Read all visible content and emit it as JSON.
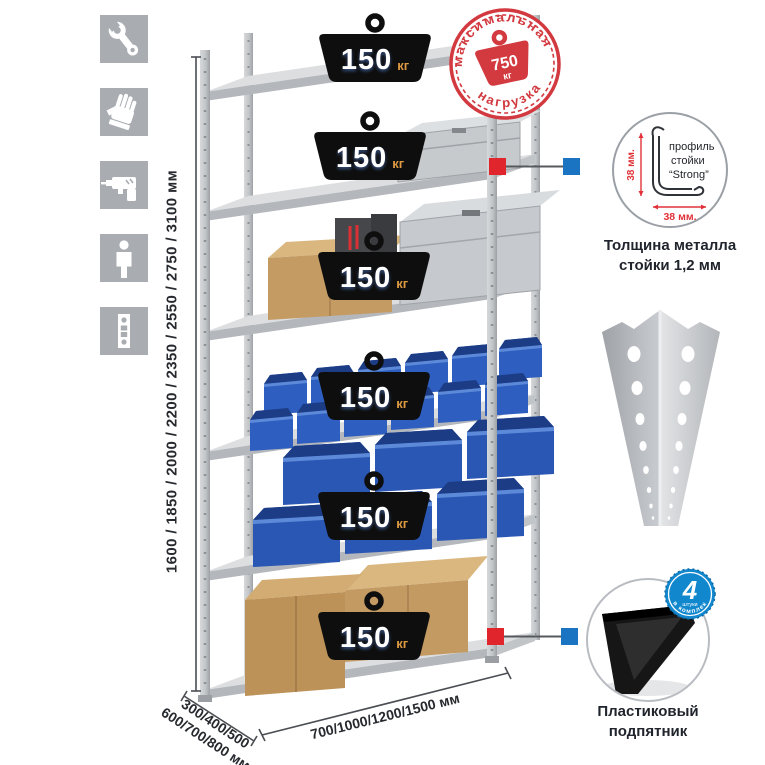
{
  "product": "metal-shelving-rack-infographic",
  "weights": [
    {
      "value": "150",
      "unit": "кг"
    },
    {
      "value": "150",
      "unit": "кг"
    },
    {
      "value": "150",
      "unit": "кг"
    },
    {
      "value": "150",
      "unit": "кг"
    },
    {
      "value": "150",
      "unit": "кг"
    },
    {
      "value": "150",
      "unit": "кг"
    }
  ],
  "stamp": {
    "top_text": "максимальная",
    "bottom_text": "нагрузка",
    "value": "750",
    "unit": "кг"
  },
  "dimensions": {
    "height": "1600 / 1850 / 2000 / 2200 / 2350 / 2550 / 2750 / 3100 мм",
    "depth_line1": "300/400/500",
    "depth_line2": "600/700/800 мм",
    "width": "700/1000/1200/1500 мм"
  },
  "profile_detail": {
    "line1": "профиль",
    "line2": "стойки",
    "line3": "“Strong”",
    "dim_vertical": "38 мм.",
    "dim_horizontal": "38 мм.",
    "caption1": "Толщина металла",
    "caption2": "стойки 1,2 мм"
  },
  "foot_detail": {
    "badge_value": "4",
    "badge_small": "штуки",
    "badge_arc": "в комплекте",
    "caption1": "Пластиковый",
    "caption2": "подпятник"
  },
  "left_icons": {
    "items": [
      {
        "name": "wrench-icon"
      },
      {
        "name": "gloves-icon"
      },
      {
        "name": "drill-icon"
      },
      {
        "name": "person-icon"
      },
      {
        "name": "perforated-post-icon"
      }
    ]
  },
  "colors": {
    "accent_red": "#d93036",
    "accent_blue": "#1b74c2",
    "badge_blue": "#1187cd",
    "bin_blue": "#2e5fc0",
    "metal_gray": "#c8cbce",
    "icon_gray": "#a9adb2",
    "cardboard": "#c39a66",
    "weight_black": "#0e0e0e",
    "weight_unit_orange": "#dd9a42"
  }
}
